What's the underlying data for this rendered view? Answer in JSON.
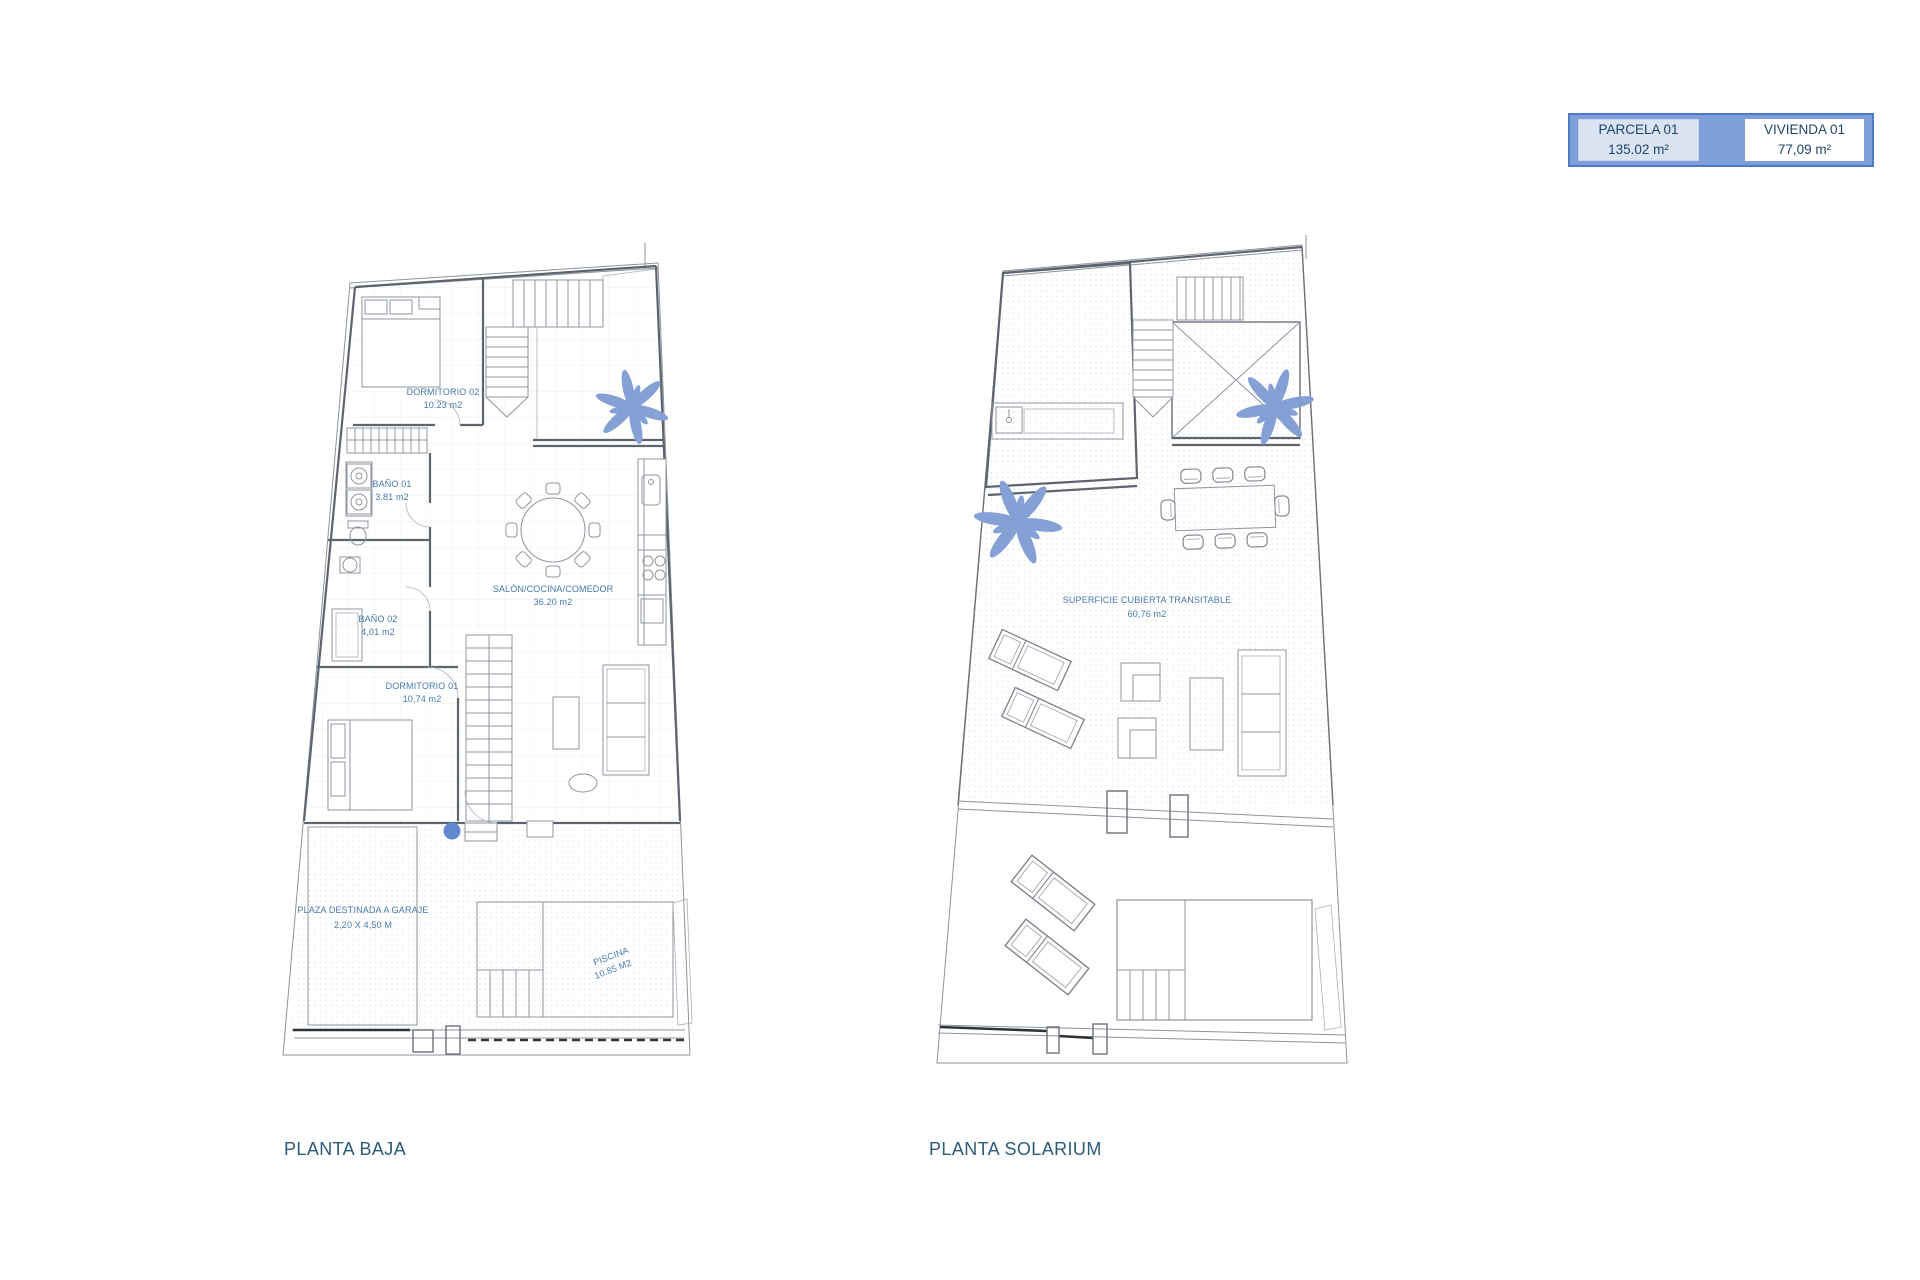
{
  "legend": {
    "cells": [
      {
        "label": "PARCELA 01",
        "value": "135.02 m²"
      },
      {
        "label": "VIVIENDA 01",
        "value": "77,09 m²"
      }
    ]
  },
  "planta_baja": {
    "title": "PLANTA BAJA",
    "labels": {
      "dormitorio02": {
        "name": "DORMITORIO 02",
        "area": "10.23 m2"
      },
      "bano01": {
        "name": "BAÑO 01",
        "area": "3.81 m2"
      },
      "bano02": {
        "name": "BAÑO 02",
        "area": "4,01 m2"
      },
      "dormitorio01": {
        "name": "DORMITORIO 01",
        "area": "10,74 m2"
      },
      "salon": {
        "name": "SALÓN/COCINA/COMEDOR",
        "area": "36.20 m2"
      },
      "garaje": {
        "name": "PLAZA DESTINADA A GARAJE",
        "dims": "2,20 X 4,50 M"
      },
      "piscina": {
        "name": "PISCINA",
        "area": "10.85 M2"
      }
    }
  },
  "planta_solarium": {
    "title": "PLANTA SOLARIUM",
    "labels": {
      "superficie": {
        "name": "SUPERFICIE CUBIERTA TRANSITABLE",
        "area": "60,76 m2"
      }
    }
  },
  "colors": {
    "accent_blue": "#4d7ac2",
    "legend_fill": "#7e9ed9",
    "legend_cell": "#d9e3f2",
    "legend_text": "#1f456b",
    "title_text": "#2e5b78",
    "room_label": "#4579ab",
    "palm": "#84a0d4",
    "pool_fill": "#e9eef2",
    "pool_dot": "#6188cf"
  }
}
